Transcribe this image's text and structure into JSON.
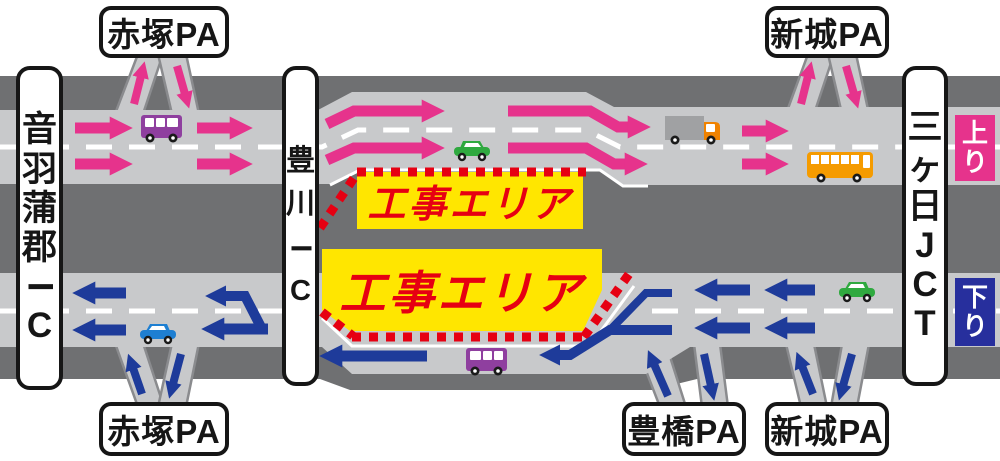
{
  "colors": {
    "pink": "#E6338C",
    "blue": "#1E3B9A",
    "badge_blue": "#272F9D",
    "yellow": "#FFE600",
    "red": "#E60012",
    "road_light": "#C8C9CB",
    "road_dark": "#6F7072",
    "ramp_edge": "#8A8B8E",
    "van_purple": "#8F3F9F",
    "car_green": "#2FA93F",
    "car_blue": "#1E7FD2",
    "truck_gray": "#A0A1A3",
    "truck_cab_orange": "#F08200",
    "bus_orange": "#F59B00"
  },
  "diagram": {
    "interchanges": {
      "left": "音羽蒲郡IC",
      "center": "豊川IC",
      "right": "三ヶ日JCT"
    },
    "parking_areas": {
      "top_left": "赤塚PA",
      "top_right": "新城PA",
      "bottom_left": "赤塚PA",
      "bottom_center": "豊橋PA",
      "bottom_right": "新城PA"
    },
    "direction_badges": {
      "up": "上り",
      "down": "下り"
    },
    "construction_areas": {
      "up_line": "工事エリア",
      "down_line": "工事エリア"
    }
  }
}
